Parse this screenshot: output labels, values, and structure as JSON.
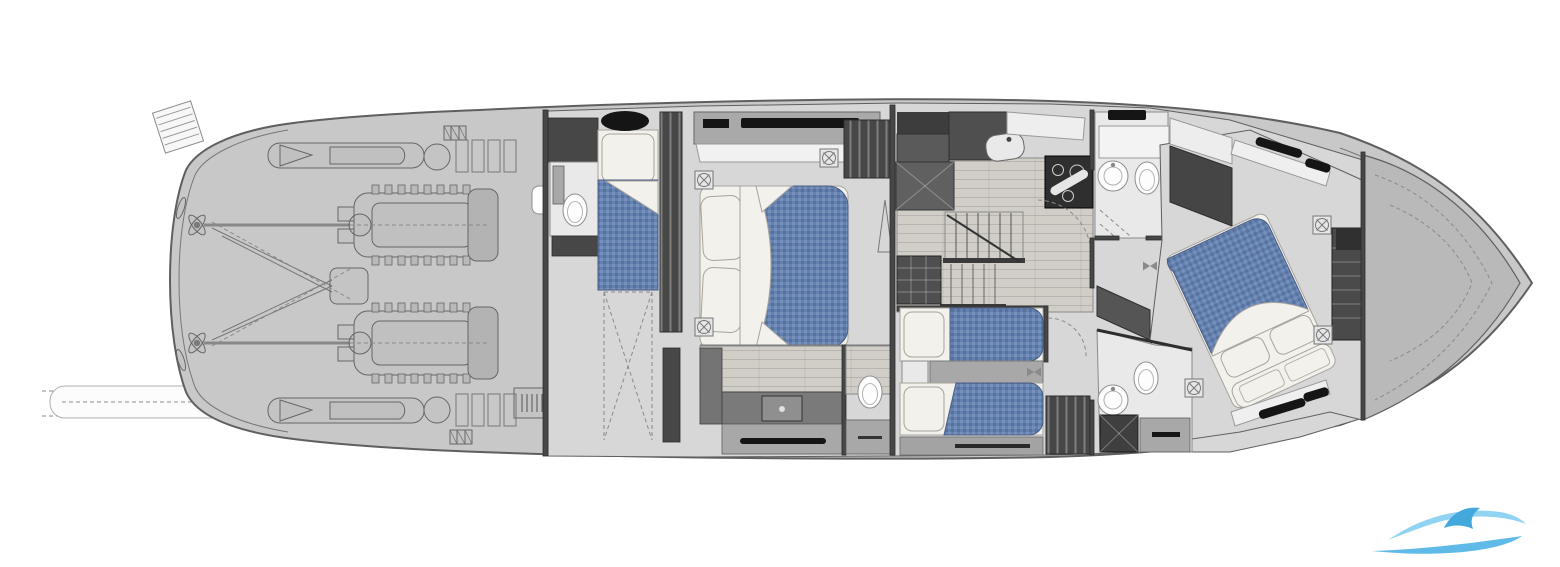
{
  "figure": {
    "aria_label": "Motor yacht lower deck floor plan, top view line drawing",
    "type": "floor-plan"
  },
  "colors": {
    "bg": "#ffffff",
    "hull": "#c8c8c8",
    "outline": "#5f5f5f",
    "deck": "#b9b9b9",
    "floor": "#d7d7d7",
    "floor-light": "#e9e9e9",
    "wood": "#d1cdc7",
    "wall": "#474747",
    "wall-dark": "#2e2e2e",
    "cabinet": "#747474",
    "cabinet-light": "#a8a8a8",
    "fixture": "#fdfdfd",
    "bedding": "#f2f1ec",
    "mattress": "#6381b1",
    "black": "#151515",
    "logo-light": "#86cff2",
    "logo-mid": "#4fb3e6",
    "logo-dark": "#2f9fd8"
  },
  "rooms": [
    {
      "name": "engine-room",
      "features": [
        "twin-engines",
        "propeller-shafts",
        "exhaust-tubes",
        "mufflers",
        "swim-ladder",
        "passerelle"
      ]
    },
    {
      "name": "crew-cabin",
      "features": [
        "single-berth",
        "wc",
        "deck-hatch",
        "companionway"
      ]
    },
    {
      "name": "master-cabin",
      "features": [
        "double-bed",
        "tv-sideboard",
        "hanging-locker",
        "ensuite-vanity",
        "wc"
      ]
    },
    {
      "name": "galley",
      "features": [
        "sink",
        "cooktop",
        "dinette-table",
        "staircase",
        "drawer-unit"
      ]
    },
    {
      "name": "twin-guest-cabin",
      "features": [
        "two-single-beds",
        "nightstand",
        "hanging-locker"
      ]
    },
    {
      "name": "day-head",
      "features": [
        "round-sink",
        "wc",
        "shower"
      ]
    },
    {
      "name": "vip-bathroom",
      "features": [
        "round-sink",
        "wc",
        "shower"
      ]
    },
    {
      "name": "vip-cabin",
      "features": [
        "diagonal-double-bed",
        "foot-bench",
        "drawer-steps",
        "hull-windows"
      ]
    },
    {
      "name": "bow",
      "features": [
        "collision-bulkhead"
      ]
    }
  ],
  "watermark": {
    "icon": "wave-swoosh-logo"
  }
}
